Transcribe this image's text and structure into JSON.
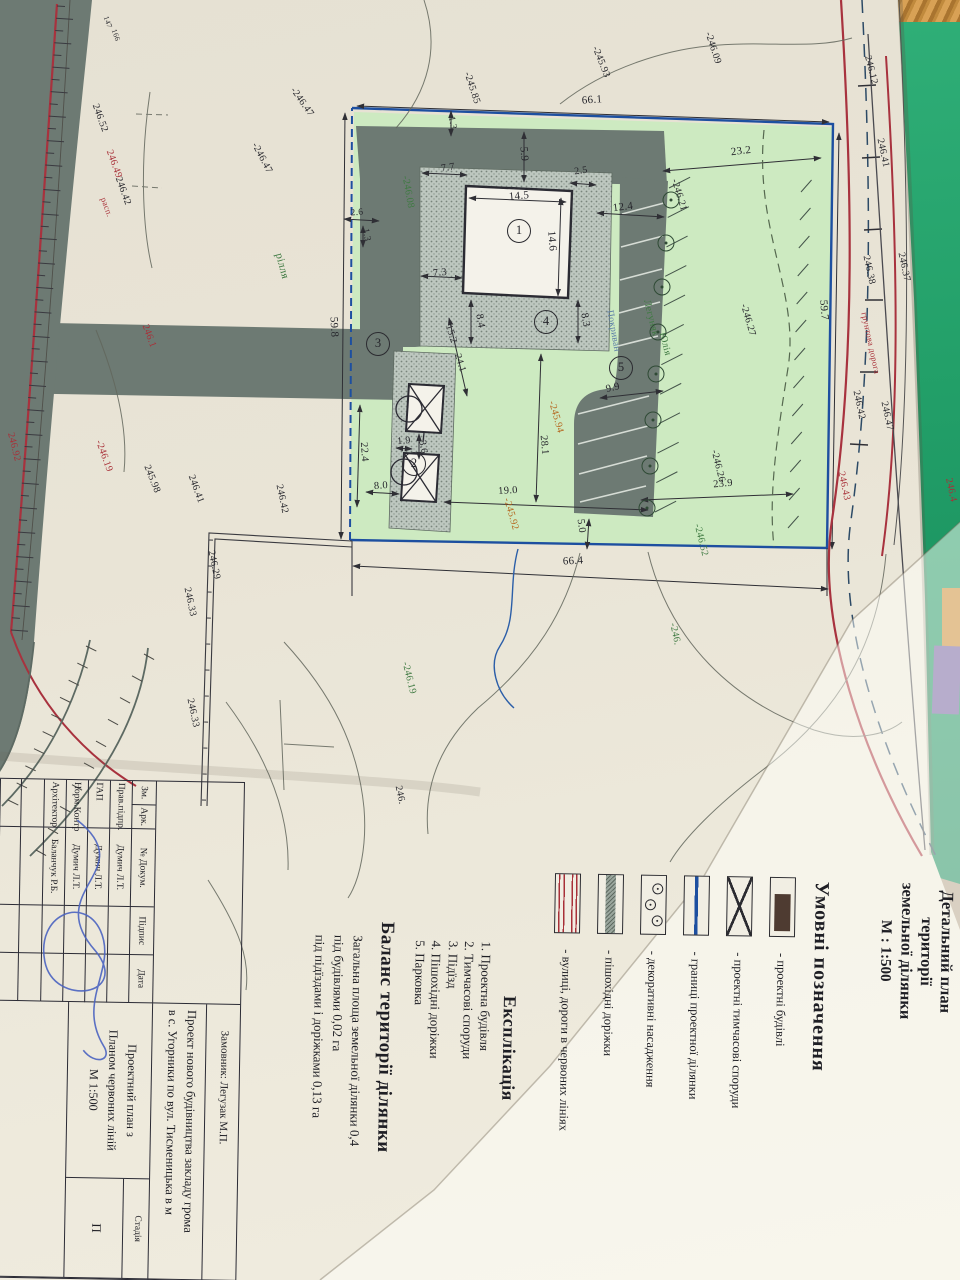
{
  "doc": {
    "title_lines": [
      "Детальний план території",
      "земельної ділянки",
      "М : 1:500"
    ]
  },
  "legend": {
    "heading": "Умовні позначення",
    "items": [
      "- проектні будівлі",
      "- проектні тимчасові споруди",
      "- границі проектної ділянки",
      "- декоративні насадження",
      "- пішохідні доріжки",
      "- вулиці, дороги в червоних лініях"
    ]
  },
  "explication": {
    "heading": "Експлікація",
    "items": [
      "1. Проектна будівля",
      "2. Тимчасові споруди",
      "3. Підїзд",
      "4. Пішохідні доріжки",
      "5. Парковка"
    ]
  },
  "balance": {
    "heading": "Баланс території ділянки",
    "lines": [
      "Загальна площа земельної ділянки  0,4",
      "під будівлями 0,02 га",
      "під підїздами і доріжками 0,13 га"
    ]
  },
  "stamp": {
    "header": [
      "Зм.",
      "Арк.",
      "№ Докум.",
      "Підпис",
      "Дата"
    ],
    "rows": [
      {
        "role": "Прав.підпр.",
        "name": "Думич Л.Т."
      },
      {
        "role": "ГАП",
        "name": "Думич Л.Т."
      },
      {
        "role": "Норм.Контр",
        "name": "Думич Л.Т."
      },
      {
        "role": "Архітектор",
        "name": "Баланчук Р.Б."
      }
    ],
    "client": "Замовник: Легузак М.П.",
    "project_line1": "Проект нового будівництва закладу грома",
    "project_line2": "в с. Угорники по вул. Тисменицька в м",
    "drawing_name_lines": [
      "Проектний план з",
      "Планом червоних ліній",
      "М 1:500"
    ],
    "stage_label": "Стадія",
    "stage_value": "П"
  },
  "colors": {
    "parcel_green": "#cdeac1",
    "road_gray": "#6d7a73",
    "boundary_blue": "#1d4fa0",
    "red_line": "#a8323e",
    "building_brown": "#4e3b31",
    "mat_green": "#23a069"
  },
  "plan": {
    "labels": [
      {
        "t": "66.1",
        "x": 592,
        "y": 100,
        "r": -4,
        "c": "d",
        "s": 11
      },
      {
        "t": "23.2",
        "x": 741,
        "y": 151,
        "r": -7,
        "c": "d",
        "s": 11
      },
      {
        "t": "59.7",
        "x": 824,
        "y": 310,
        "r": 85,
        "c": "d",
        "s": 11
      },
      {
        "t": "59.8",
        "x": 334,
        "y": 327,
        "r": 87,
        "c": "d",
        "s": 11
      },
      {
        "t": "66.4",
        "x": 573,
        "y": 561,
        "r": -3,
        "c": "d",
        "s": 11
      },
      {
        "t": "5.9",
        "x": 524,
        "y": 154,
        "r": 85,
        "c": "d",
        "s": 11
      },
      {
        "t": "2.5",
        "x": 581,
        "y": 171,
        "r": -8,
        "c": "d",
        "s": 10
      },
      {
        "t": "14.5",
        "x": 519,
        "y": 196,
        "r": -5,
        "c": "d",
        "s": 11
      },
      {
        "t": "14.6",
        "x": 552,
        "y": 241,
        "r": 85,
        "c": "d",
        "s": 11
      },
      {
        "t": "12.4",
        "x": 623,
        "y": 207,
        "r": -7,
        "c": "d",
        "s": 11
      },
      {
        "t": "7.7",
        "x": 448,
        "y": 168,
        "r": -8,
        "c": "d",
        "s": 10.5
      },
      {
        "t": "7.3",
        "x": 440,
        "y": 273,
        "r": -6,
        "c": "d",
        "s": 10.5
      },
      {
        "t": "8.4",
        "x": 480,
        "y": 321,
        "r": 80,
        "c": "d",
        "s": 10.5
      },
      {
        "t": "8.3",
        "x": 585,
        "y": 320,
        "r": 80,
        "c": "d",
        "s": 10.5
      },
      {
        "t": "15.2",
        "x": 451,
        "y": 334,
        "r": 72,
        "c": "d",
        "s": 10
      },
      {
        "t": "24.1",
        "x": 460,
        "y": 363,
        "r": 72,
        "c": "d",
        "s": 10
      },
      {
        "t": "1.9",
        "x": 404,
        "y": 441,
        "r": -5,
        "c": "d",
        "s": 10
      },
      {
        "t": "3.6",
        "x": 423,
        "y": 447,
        "r": 80,
        "c": "d",
        "s": 10
      },
      {
        "t": "22.4",
        "x": 364,
        "y": 452,
        "r": 86,
        "c": "d",
        "s": 10.5
      },
      {
        "t": "8.0",
        "x": 381,
        "y": 486,
        "r": -4,
        "c": "d",
        "s": 10.5
      },
      {
        "t": "19.0",
        "x": 508,
        "y": 491,
        "r": -4,
        "c": "d",
        "s": 10.5
      },
      {
        "t": "28.1",
        "x": 544,
        "y": 445,
        "r": 85,
        "c": "d",
        "s": 10.5
      },
      {
        "t": "5.0",
        "x": 581,
        "y": 526,
        "r": 83,
        "c": "d",
        "s": 10.5
      },
      {
        "t": "9.9",
        "x": 613,
        "y": 388,
        "r": -14,
        "c": "d",
        "s": 10.5
      },
      {
        "t": "23.9",
        "x": 723,
        "y": 484,
        "r": -5,
        "c": "d",
        "s": 10.5
      },
      {
        "t": "2.6",
        "x": 357,
        "y": 213,
        "r": -5,
        "c": "d",
        "s": 9.5
      },
      {
        "t": "1.3",
        "x": 366,
        "y": 235,
        "r": 80,
        "c": "d",
        "s": 9.5
      },
      {
        "t": "1.3",
        "x": 452,
        "y": 123,
        "r": 80,
        "c": "d",
        "s": 9.5
      },
      {
        "t": "-245.85",
        "x": 472,
        "y": 88,
        "r": 72,
        "c": "d",
        "s": 10
      },
      {
        "t": "-245.93",
        "x": 601,
        "y": 62,
        "r": 68,
        "c": "d",
        "s": 10
      },
      {
        "t": "-246.09",
        "x": 713,
        "y": 48,
        "r": 72,
        "c": "d",
        "s": 10
      },
      {
        "t": "-246.47",
        "x": 302,
        "y": 102,
        "r": 55,
        "c": "d",
        "s": 10
      },
      {
        "t": "-246.47",
        "x": 262,
        "y": 158,
        "r": 62,
        "c": "d",
        "s": 10
      },
      {
        "t": "246.52",
        "x": 100,
        "y": 118,
        "r": 70,
        "c": "d",
        "s": 10
      },
      {
        "t": "246.49",
        "x": 114,
        "y": 164,
        "r": 70,
        "c": "r",
        "s": 10
      },
      {
        "t": "246.42",
        "x": 123,
        "y": 191,
        "r": 70,
        "c": "d",
        "s": 10
      },
      {
        "t": "расп.",
        "x": 107,
        "y": 207,
        "r": 70,
        "c": "r",
        "s": 8.5
      },
      {
        "t": "147",
        "x": 108,
        "y": 22,
        "r": 70,
        "c": "d",
        "s": 7.5
      },
      {
        "t": "166",
        "x": 116,
        "y": 35,
        "r": 70,
        "c": "d",
        "s": 7.5
      },
      {
        "t": "рілля",
        "x": 282,
        "y": 266,
        "r": 75,
        "c": "g",
        "s": 11
      },
      {
        "t": "-246.08",
        "x": 408,
        "y": 192,
        "r": 80,
        "c": "g",
        "s": 10
      },
      {
        "t": "-246.21",
        "x": 679,
        "y": 195,
        "r": 73,
        "c": "d",
        "s": 10
      },
      {
        "t": "-246.27",
        "x": 748,
        "y": 320,
        "r": 74,
        "c": "d",
        "s": 10
      },
      {
        "t": "Легуняк",
        "x": 651,
        "y": 318,
        "r": 76,
        "c": "g",
        "s": 10
      },
      {
        "t": "Юлія",
        "x": 665,
        "y": 344,
        "r": 76,
        "c": "g",
        "s": 10
      },
      {
        "t": "Покриван",
        "x": 613,
        "y": 331,
        "r": 80,
        "c": "b",
        "s": 9.5
      },
      {
        "t": "-245.94",
        "x": 556,
        "y": 417,
        "r": 74,
        "c": "o",
        "s": 10
      },
      {
        "t": "-245.92",
        "x": 511,
        "y": 514,
        "r": 74,
        "c": "o",
        "s": 10
      },
      {
        "t": "-246.26",
        "x": 718,
        "y": 466,
        "r": 76,
        "c": "d",
        "s": 10
      },
      {
        "t": "-246.52",
        "x": 701,
        "y": 540,
        "r": 76,
        "c": "g",
        "s": 10
      },
      {
        "t": "-246.",
        "x": 675,
        "y": 634,
        "r": 78,
        "c": "g",
        "s": 10
      },
      {
        "t": "-246.19",
        "x": 409,
        "y": 678,
        "r": 76,
        "c": "g",
        "s": 10
      },
      {
        "t": "246.",
        "x": 400,
        "y": 795,
        "r": 78,
        "c": "d",
        "s": 10
      },
      {
        "t": "246.29",
        "x": 214,
        "y": 565,
        "r": 78,
        "c": "d",
        "s": 10
      },
      {
        "t": "246.33",
        "x": 190,
        "y": 602,
        "r": 78,
        "c": "d",
        "s": 10
      },
      {
        "t": "246.33",
        "x": 193,
        "y": 713,
        "r": 78,
        "c": "d",
        "s": 10
      },
      {
        "t": "246.41",
        "x": 196,
        "y": 489,
        "r": 70,
        "c": "d",
        "s": 10
      },
      {
        "t": "245.98",
        "x": 152,
        "y": 479,
        "r": 68,
        "c": "d",
        "s": 10
      },
      {
        "t": "246.42",
        "x": 282,
        "y": 499,
        "r": 78,
        "c": "d",
        "s": 10
      },
      {
        "t": "-246.19",
        "x": 104,
        "y": 456,
        "r": 70,
        "c": "r",
        "s": 10
      },
      {
        "t": "246.92",
        "x": 14,
        "y": 447,
        "r": 76,
        "c": "r",
        "s": 10
      },
      {
        "t": "246.1",
        "x": 149,
        "y": 336,
        "r": 70,
        "c": "r",
        "s": 10
      },
      {
        "t": "246.12",
        "x": 871,
        "y": 70,
        "r": 76,
        "c": "d",
        "s": 10
      },
      {
        "t": "246.41",
        "x": 883,
        "y": 153,
        "r": 78,
        "c": "d",
        "s": 10
      },
      {
        "t": "246.37",
        "x": 904,
        "y": 267,
        "r": 78,
        "c": "d",
        "s": 10
      },
      {
        "t": "246.38",
        "x": 869,
        "y": 270,
        "r": 78,
        "c": "d",
        "s": 10
      },
      {
        "t": "грунтова дорога",
        "x": 871,
        "y": 343,
        "r": 78,
        "c": "r",
        "s": 8.5
      },
      {
        "t": "246.42",
        "x": 859,
        "y": 405,
        "r": 78,
        "c": "d",
        "s": 10
      },
      {
        "t": "246.47",
        "x": 887,
        "y": 416,
        "r": 78,
        "c": "d",
        "s": 10
      },
      {
        "t": "246.43",
        "x": 844,
        "y": 486,
        "r": 78,
        "c": "r",
        "s": 10
      },
      {
        "t": "246.4",
        "x": 951,
        "y": 490,
        "r": 78,
        "c": "r",
        "s": 10
      }
    ],
    "circled_numbers": [
      {
        "n": "1",
        "x": 519,
        "y": 231
      },
      {
        "n": "2",
        "x": 414,
        "y": 464
      },
      {
        "n": "3",
        "x": 378,
        "y": 344
      },
      {
        "n": "4",
        "x": 546,
        "y": 322
      },
      {
        "n": "5",
        "x": 621,
        "y": 368
      }
    ],
    "trees": [
      {
        "x": 671,
        "y": 200
      },
      {
        "x": 666,
        "y": 243
      },
      {
        "x": 662,
        "y": 287
      },
      {
        "x": 658,
        "y": 332
      },
      {
        "x": 656,
        "y": 374
      },
      {
        "x": 653,
        "y": 420
      },
      {
        "x": 650,
        "y": 466
      },
      {
        "x": 647,
        "y": 508
      }
    ]
  }
}
